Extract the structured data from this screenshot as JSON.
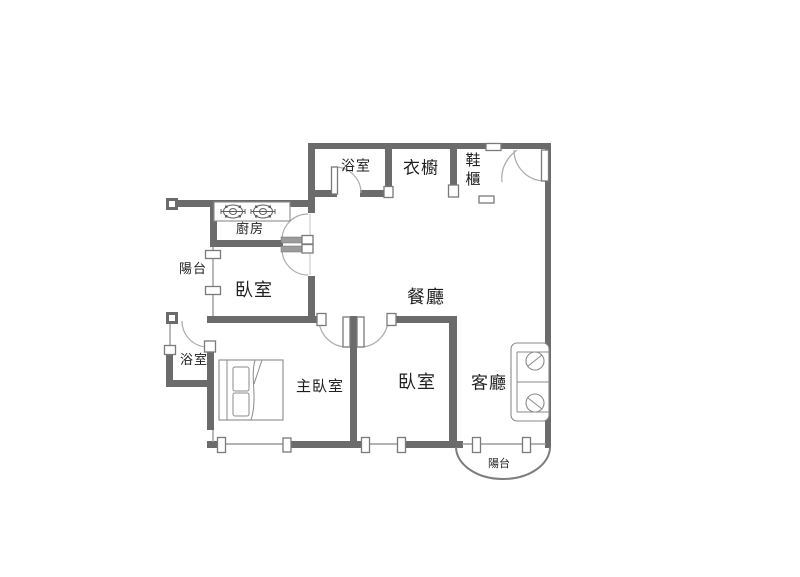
{
  "page": {
    "title": "Apartment floor plan"
  },
  "colors": {
    "wall": "#6b6b6b",
    "thin": "#9a9a9a",
    "arc": "#ababab",
    "furn": "#8a8a8a",
    "jamb": "#7a7a7a",
    "text": "#1f1f1f",
    "bg": "#ffffff"
  },
  "rooms": {
    "bath_top": "浴室",
    "wardrobe": "衣櫥",
    "shoe_cabinet": {
      "line1": "鞋",
      "line2": "櫃"
    },
    "kitchen": "廚房",
    "balcony_left": "陽台",
    "bedroom_upper": "臥室",
    "dining": "餐廳",
    "bath_lower": "浴室",
    "master_bedroom": "主臥室",
    "bedroom_lower": "臥室",
    "living_room": "客廳",
    "balcony_bottom": "陽台"
  }
}
